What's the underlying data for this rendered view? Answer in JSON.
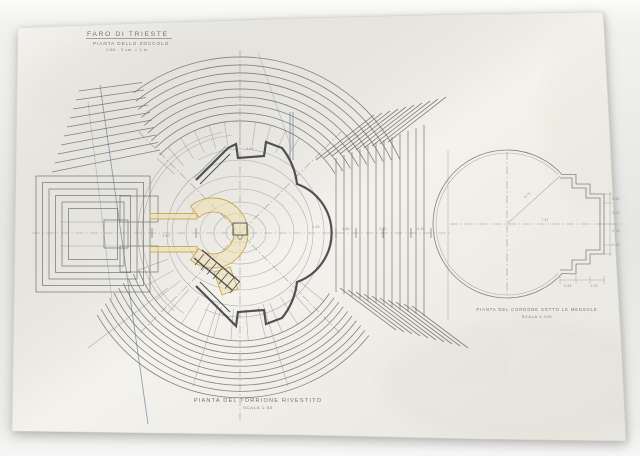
{
  "title_block": {
    "line1": "FARO DI TRIESTE",
    "line2": "PIANTA DELLO ZOCCOLO",
    "line3": "1:50 - 2 cm. = 1 m."
  },
  "main_caption": {
    "title": "PIANTA DEL TORRIONE RIVESTITO",
    "scale": "SCALA 1:50"
  },
  "detail_caption": {
    "title": "PIANTA DEL CORDONE SOTTO LE MENSOLE",
    "scale": "SCALA 1:100"
  },
  "colors": {
    "pencil": "#9a9a96",
    "pencil_dark": "#6f6f6b",
    "ink": "#3f3e44",
    "blue": "#7d89a2",
    "ochre": "#c79f3e",
    "ochre_fill": "#efe0b4",
    "text": "#75736a",
    "paper": "#f4f2ec",
    "background": "#e7e7e5"
  },
  "drawing": {
    "main_center": [
      240,
      233
    ],
    "rings": [
      [
        14,
        10
      ],
      [
        26,
        20
      ],
      [
        40,
        31
      ],
      [
        54,
        44
      ],
      [
        68,
        57
      ],
      [
        73,
        73
      ]
    ],
    "guide_arcs": [
      {
        "r": 84,
        "a0": 120,
        "a1": -115
      },
      {
        "r": 98,
        "a0": 235,
        "a1": 95
      },
      {
        "r": 102,
        "a0": 230,
        "a1": 100
      }
    ],
    "top_arcs": {
      "count": 9,
      "r0": 112,
      "dr": 8,
      "aL0": 136,
      "aLd": -1.1,
      "aR0": 32,
      "aRd": -0.9
    },
    "bottom_arcs": {
      "count": 10,
      "r0": 108,
      "dr": 6.3,
      "aL0": 200,
      "aLd": 1.1,
      "aR0": 326,
      "aRd": -0.5
    },
    "spokes_top": {
      "a0": 58,
      "a1": 138,
      "da": 8,
      "r1": 88,
      "r2": 112
    },
    "spokes_bottom": {
      "a0": 200,
      "a1": 330,
      "da": 9.3,
      "r1": 76,
      "r2": 108
    },
    "e_fan": {
      "count": 12,
      "x0": 336,
      "dx": 8,
      "ytop0": 158,
      "ytopd": -3,
      "ybot0": 292,
      "ybotd": 2.2
    },
    "ne_band": {
      "count": 10,
      "x0": 316,
      "dx": 8,
      "y0": 160,
      "dy": -2,
      "ex": 58,
      "ey": -45
    },
    "se_band": {
      "count": 10,
      "x0": 340,
      "dx": 8,
      "y0": 288,
      "dy": 2,
      "ex": 56,
      "ey": 42
    },
    "nw_fan": {
      "count": 10,
      "x00": 52,
      "dx0": 3,
      "y00": 172,
      "dy0": -9,
      "x10": 160,
      "dx1": -2,
      "y10": 150,
      "dy1": -7.5
    },
    "left_rects": {
      "x": 36,
      "y": 176,
      "w": 114,
      "h": 116,
      "inset": 6.5,
      "count": 6
    },
    "detail": {
      "center": [
        507,
        224
      ],
      "r_outer": 74,
      "r_inner": 71,
      "gap_a0": 42,
      "gap_a1": -42
    }
  },
  "dims_main": [
    {
      "t": "1.50",
      "x": 166,
      "y": 237
    },
    {
      "t": "0.60",
      "x": 346,
      "y": 230
    },
    {
      "t": "2.10",
      "x": 383,
      "y": 230
    },
    {
      "t": "0.45",
      "x": 421,
      "y": 230
    },
    {
      "t": "1.45",
      "x": 316,
      "y": 228
    },
    {
      "t": "0.95",
      "x": 250,
      "y": 150
    }
  ],
  "dims_detail": [
    {
      "t": "3.75",
      "x": 528,
      "y": 196,
      "r": -40
    },
    {
      "t": "7.47",
      "x": 545,
      "y": 221
    },
    {
      "t": "0.30",
      "x": 616,
      "y": 200
    },
    {
      "t": "0.62",
      "x": 616,
      "y": 214
    },
    {
      "t": "0.74",
      "x": 616,
      "y": 232
    },
    {
      "t": "0.30",
      "x": 616,
      "y": 246
    },
    {
      "t": "0.95",
      "x": 568,
      "y": 287
    },
    {
      "t": "1.05",
      "x": 594,
      "y": 287
    }
  ]
}
